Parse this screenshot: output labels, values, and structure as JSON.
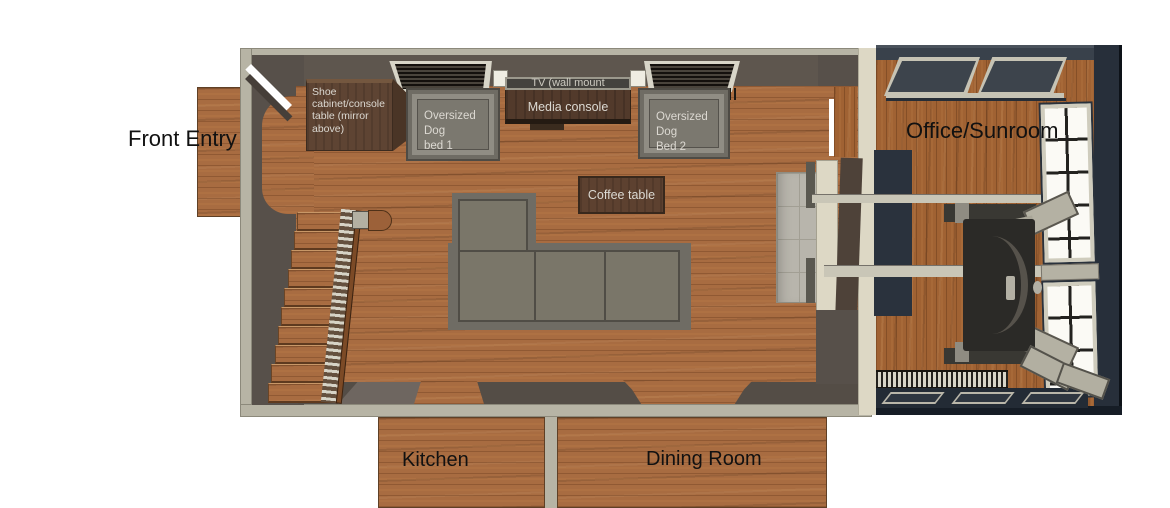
{
  "rooms": {
    "front_entry": {
      "label": "Front Entry"
    },
    "living_room": {
      "furniture": {
        "shoe_cabinet": {
          "label": "Shoe cabinet/console table (mirror above)"
        },
        "dog_bed_1": {
          "label_lines": [
            "Oversized Dog",
            "bed 1"
          ]
        },
        "tv": {
          "label": "TV (wall mount"
        },
        "media_console": {
          "label": "Media console"
        },
        "dog_bed_2": {
          "label_lines": [
            "Oversized Dog",
            "Bed 2"
          ]
        },
        "coffee_table": {
          "label": "Coffee table"
        }
      }
    },
    "office_sunroom": {
      "label": "Office/Sunroom"
    },
    "kitchen": {
      "label": "Kitchen"
    },
    "dining_room": {
      "label": "Dining Room"
    }
  },
  "colors": {
    "background": "#ffffff",
    "wood_floor": "#a86c41",
    "office_wood_floor": "#a06233",
    "outer_wall_gray": "#b7b4a5",
    "interior_wall_brown": "#57504a",
    "office_wall_navy": "#2b333e",
    "cream_trim": "#ddd8c5",
    "furniture_gray": "#6f6c64",
    "dark_wood_furniture": "#523a2b",
    "tile_gray": "#b8b5ac",
    "room_label_text": "#111111",
    "furniture_label_text": "#dcd9d2"
  }
}
